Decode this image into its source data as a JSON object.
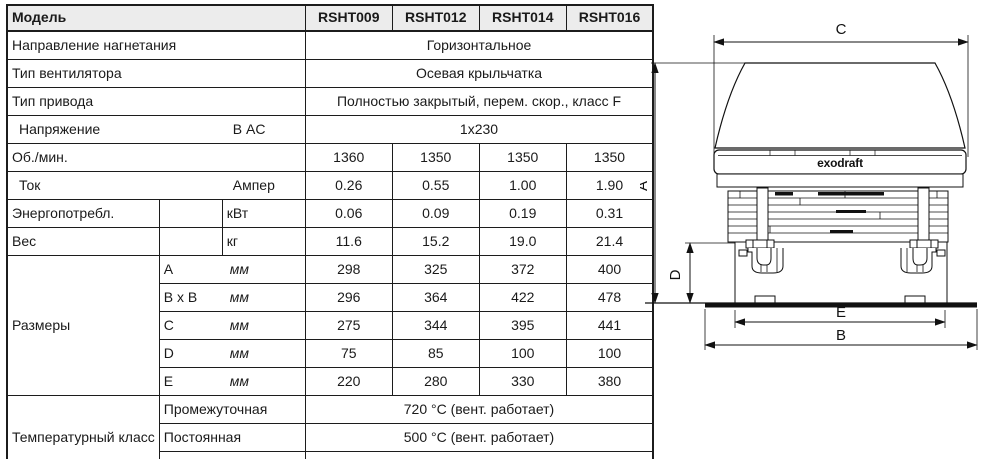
{
  "table": {
    "model_label": "Модель",
    "models": [
      "RSHT009",
      "RSHT012",
      "RSHT014",
      "RSHT016"
    ],
    "rows": {
      "discharge": {
        "label": "Направление нагнетания",
        "value": "Горизонтальное"
      },
      "fan_type": {
        "label": "Тип вентилятора",
        "value": "Осевая крыльчатка"
      },
      "drive_type": {
        "label": "Тип привода",
        "value": "Полностью закрытый, перем. скор., класс F"
      },
      "voltage": {
        "label": "Напряжение",
        "unit": "В AC",
        "value": "1x230"
      },
      "rpm": {
        "label": "Об./мин.",
        "values": [
          "1360",
          "1350",
          "1350",
          "1350"
        ]
      },
      "current": {
        "label": "Ток",
        "unit": "Ампер",
        "values": [
          "0.26",
          "0.55",
          "1.00",
          "1.90"
        ]
      },
      "power": {
        "label": "Энергопотребл.",
        "unit": "кВт",
        "values": [
          "0.06",
          "0.09",
          "0.19",
          "0.31"
        ]
      },
      "weight": {
        "label": "Вес",
        "unit": "кг",
        "values": [
          "11.6",
          "15.2",
          "19.0",
          "21.4"
        ]
      },
      "dimensions": {
        "label": "Размеры",
        "unit": "мм",
        "items": [
          {
            "dim": "A",
            "values": [
              "298",
              "325",
              "372",
              "400"
            ]
          },
          {
            "dim": "B x B",
            "values": [
              "296",
              "364",
              "422",
              "478"
            ]
          },
          {
            "dim": "C",
            "values": [
              "275",
              "344",
              "395",
              "441"
            ]
          },
          {
            "dim": "D",
            "values": [
              "75",
              "85",
              "100",
              "100"
            ]
          },
          {
            "dim": "E",
            "values": [
              "220",
              "280",
              "330",
              "380"
            ]
          }
        ]
      },
      "temperature_class": {
        "label": "Температурный класс",
        "items": [
          {
            "sub": "Промежуточная",
            "value": "720 °C (вент. работает)"
          },
          {
            "sub": "Постоянная",
            "value": "500 °C (вент. работает)"
          },
          {
            "sub": "Вент. отключен",
            "value": "Max. 250 °C (вент. не работает)"
          }
        ]
      }
    }
  },
  "drawing": {
    "brand": "exodraft",
    "dims": [
      "C",
      "A",
      "D",
      "E",
      "B"
    ]
  }
}
